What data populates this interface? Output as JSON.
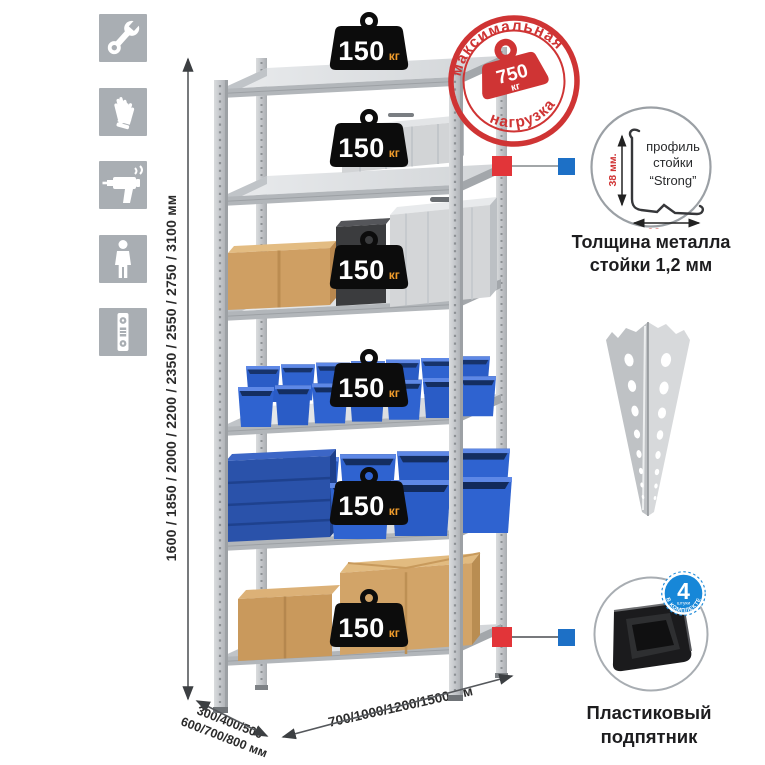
{
  "page": {
    "background": "#ffffff"
  },
  "sidebar": {
    "icons": [
      "wrench",
      "gloves",
      "drill",
      "person",
      "level"
    ]
  },
  "dimensions": {
    "height_options": "1600 / 1850 / 2000 / 2200 / 2350 / 2550 / 2750 / 3100 мм",
    "depth_options_line1": "300/400/500",
    "depth_options_line2": "600/700/800 мм",
    "width_options": "700/1000/1200/1500 мм"
  },
  "rack": {
    "shelves": [
      {
        "load": "150",
        "unit": "кг"
      },
      {
        "load": "150",
        "unit": "кг"
      },
      {
        "load": "150",
        "unit": "кг"
      },
      {
        "load": "150",
        "unit": "кг"
      },
      {
        "load": "150",
        "unit": "кг"
      },
      {
        "load": "150",
        "unit": "кг"
      }
    ]
  },
  "max_load_stamp": {
    "arc_top": "максимальная",
    "arc_bottom": "нагрузка",
    "value": "750",
    "unit": "кг"
  },
  "profile_feature": {
    "line1": "профиль",
    "line2": "стойки",
    "line3": "“Strong”",
    "dim_vertical": "38 мм.",
    "dim_horizontal": "38 мм.",
    "caption_line1": "Толщина металла",
    "caption_line2": "стойки 1,2 мм"
  },
  "foot_feature": {
    "badge_value": "4",
    "badge_small": "штуки",
    "badge_arc": "в комплекте",
    "caption_line1": "Пластиковый",
    "caption_line2": "подпятник"
  },
  "colors": {
    "stamp_red": "#cf3434",
    "connector_red": "#e23539",
    "connector_blue": "#1d70c6",
    "badge_blue": "#1787d8",
    "bin_blue": "#2a5cc6",
    "weight_black": "#0c0c0c",
    "weight_unit_orange": "#f19d2c",
    "metal_gray": "#d3d6d8",
    "icon_gray": "#a9aeb3"
  }
}
